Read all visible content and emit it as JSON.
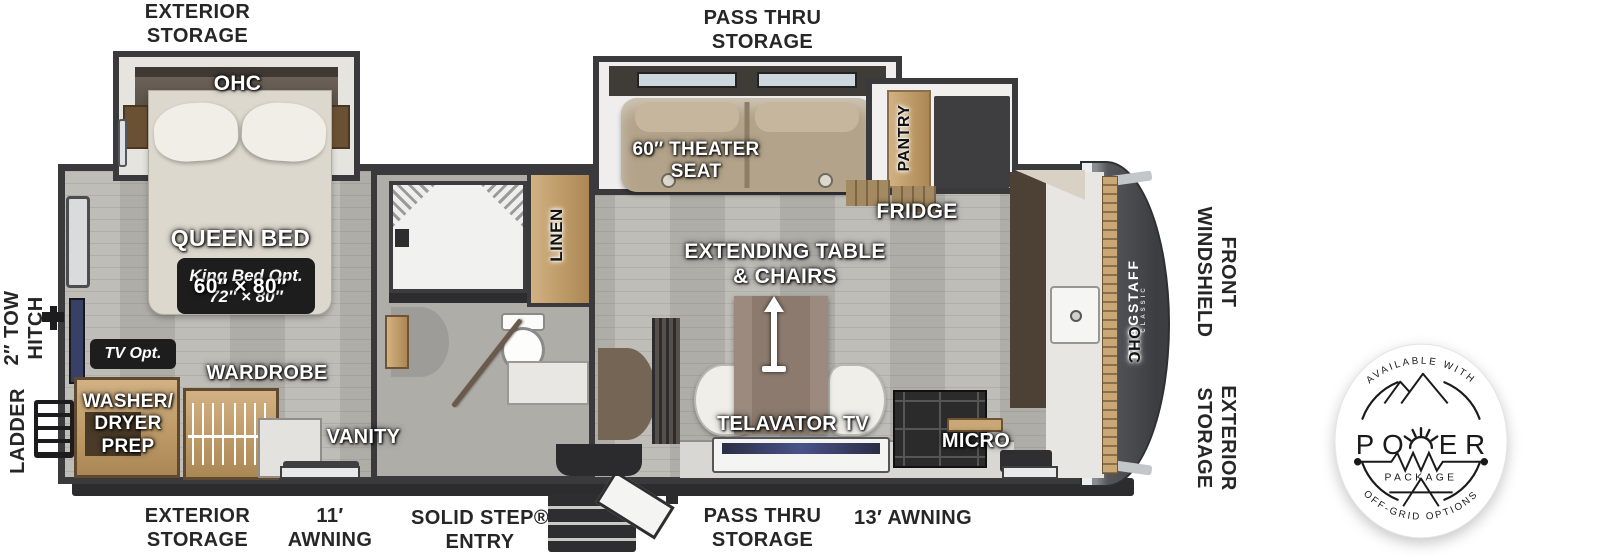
{
  "palette": {
    "wall": "#3a3a3c",
    "floor": "#b7b6b0",
    "wood": "#c3a06e",
    "front_cap": "#4b4c50",
    "badge_ink": "#1a1a1a",
    "label_white": "#ffffff",
    "label_black": "#262626"
  },
  "outer_labels": {
    "exterior_storage_top": "EXTERIOR\nSTORAGE",
    "pass_thru_storage_top": "PASS THRU\nSTORAGE",
    "tow_hitch": "2″ TOW\nHITCH",
    "ladder": "LADDER",
    "front_windshield": "FRONT\nWINDSHIELD",
    "exterior_storage_right": "EXTERIOR\nSTORAGE",
    "exterior_storage_bottom": "EXTERIOR\nSTORAGE",
    "awning_11": "11′\nAWNING",
    "solid_step_entry": "SOLID STEP®\nENTRY",
    "pass_thru_storage_bottom": "PASS THRU\nSTORAGE",
    "awning_13": "13′ AWNING"
  },
  "room_labels": {
    "ohc_bed": "OHC",
    "queen_bed": "QUEEN BED",
    "queen_bed_size": "60″ × 80″",
    "king_bed_opt": "King Bed Opt.\n72″ × 80″",
    "tv_opt": "TV Opt.",
    "wardrobe": "WARDROBE",
    "washer_dryer_prep": "WASHER/\nDRYER\nPREP",
    "vanity": "VANITY",
    "linen": "LINEN",
    "theater_seat": "60″ THEATER\nSEAT",
    "pantry": "PANTRY",
    "fridge": "FRIDGE",
    "extending_table": "EXTENDING TABLE\n& CHAIRS",
    "telavator_tv": "TELAVATOR TV",
    "micro": "MICRO",
    "ohc_front": "OHC",
    "flagstaff": "FLAGSTAFF",
    "flagstaff_sub": "CLASSIC"
  },
  "badge": {
    "available_with": "AVAILABLE WITH",
    "power_left": "PO",
    "power_right": "ER",
    "package": "PACKAGE",
    "off_grid_options": "OFF-GRID OPTIONS"
  }
}
